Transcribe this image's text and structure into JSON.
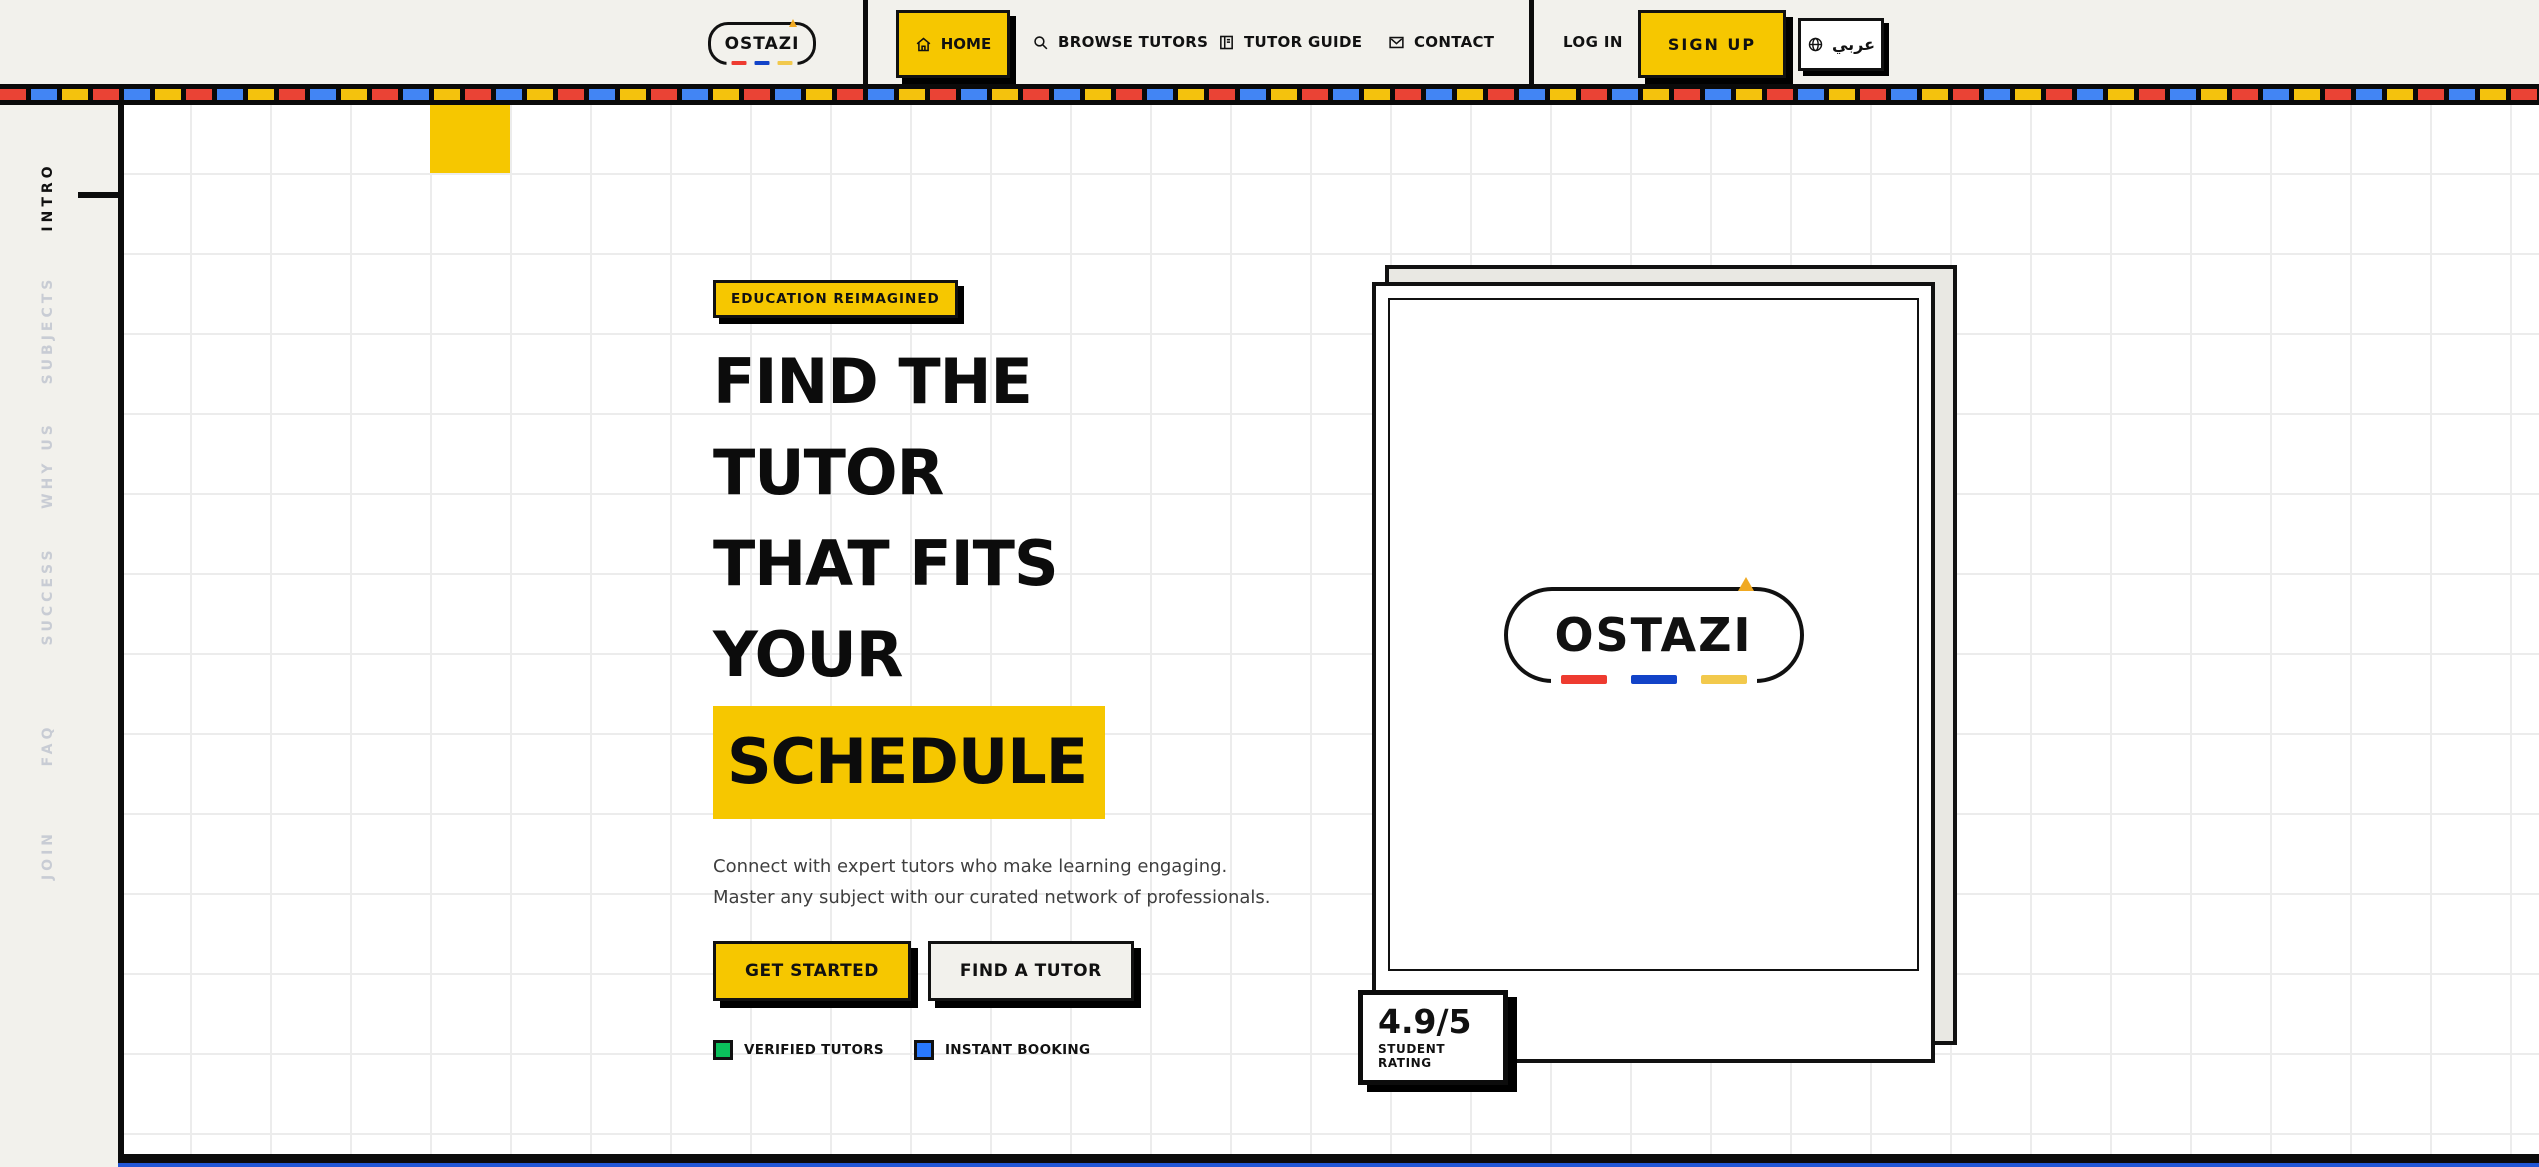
{
  "nav": {
    "logo_text": "OSTAZI",
    "items": [
      {
        "label": "HOME",
        "icon": "home-icon",
        "active": true
      },
      {
        "label": "BROWSE TUTORS",
        "icon": "search-icon",
        "active": false
      },
      {
        "label": "TUTOR GUIDE",
        "icon": "book-icon",
        "active": false
      },
      {
        "label": "CONTACT",
        "icon": "mail-icon",
        "active": false
      }
    ],
    "login_label": "LOG IN",
    "signup_label": "SIGN UP",
    "language_label": "عربي"
  },
  "sidebar": {
    "items": [
      {
        "label": "INTRO",
        "active": true
      },
      {
        "label": "SUBJECTS",
        "active": false
      },
      {
        "label": "WHY US",
        "active": false
      },
      {
        "label": "SUCCESS",
        "active": false
      },
      {
        "label": "FAQ",
        "active": false
      },
      {
        "label": "JOIN",
        "active": false
      }
    ]
  },
  "hero": {
    "badge": "EDUCATION REIMAGINED",
    "headline_lines": [
      "FIND THE",
      "TUTOR",
      "THAT FITS",
      "YOUR"
    ],
    "headline_highlight": "SCHEDULE",
    "description_line1": "Connect with expert tutors who make learning engaging.",
    "description_line2": "Master any subject with our curated network of professionals.",
    "primary_cta": "GET STARTED",
    "secondary_cta": "FIND A TUTOR",
    "legend": [
      {
        "label": "VERIFIED TUTORS",
        "color": "#0BC15C"
      },
      {
        "label": "INSTANT BOOKING",
        "color": "#2979FF"
      }
    ]
  },
  "card": {
    "logo_text": "OSTAZI",
    "rating_value": "4.9/5",
    "rating_label": "STUDENT RATING"
  },
  "colors": {
    "accent_yellow": "#F6C700",
    "background": "#F2F1EC",
    "ink": "#111111",
    "stripe_red": "#EA4335",
    "stripe_blue": "#4285F4",
    "stripe_yellow": "#F4C20D",
    "logo_dash_red": "#EE3B30",
    "logo_dash_blue": "#1243C8",
    "logo_dash_yellow": "#F2C94C",
    "bottom_strip_blue": "#2257D6",
    "inactive_rail_gray": "#C8CCD4"
  }
}
